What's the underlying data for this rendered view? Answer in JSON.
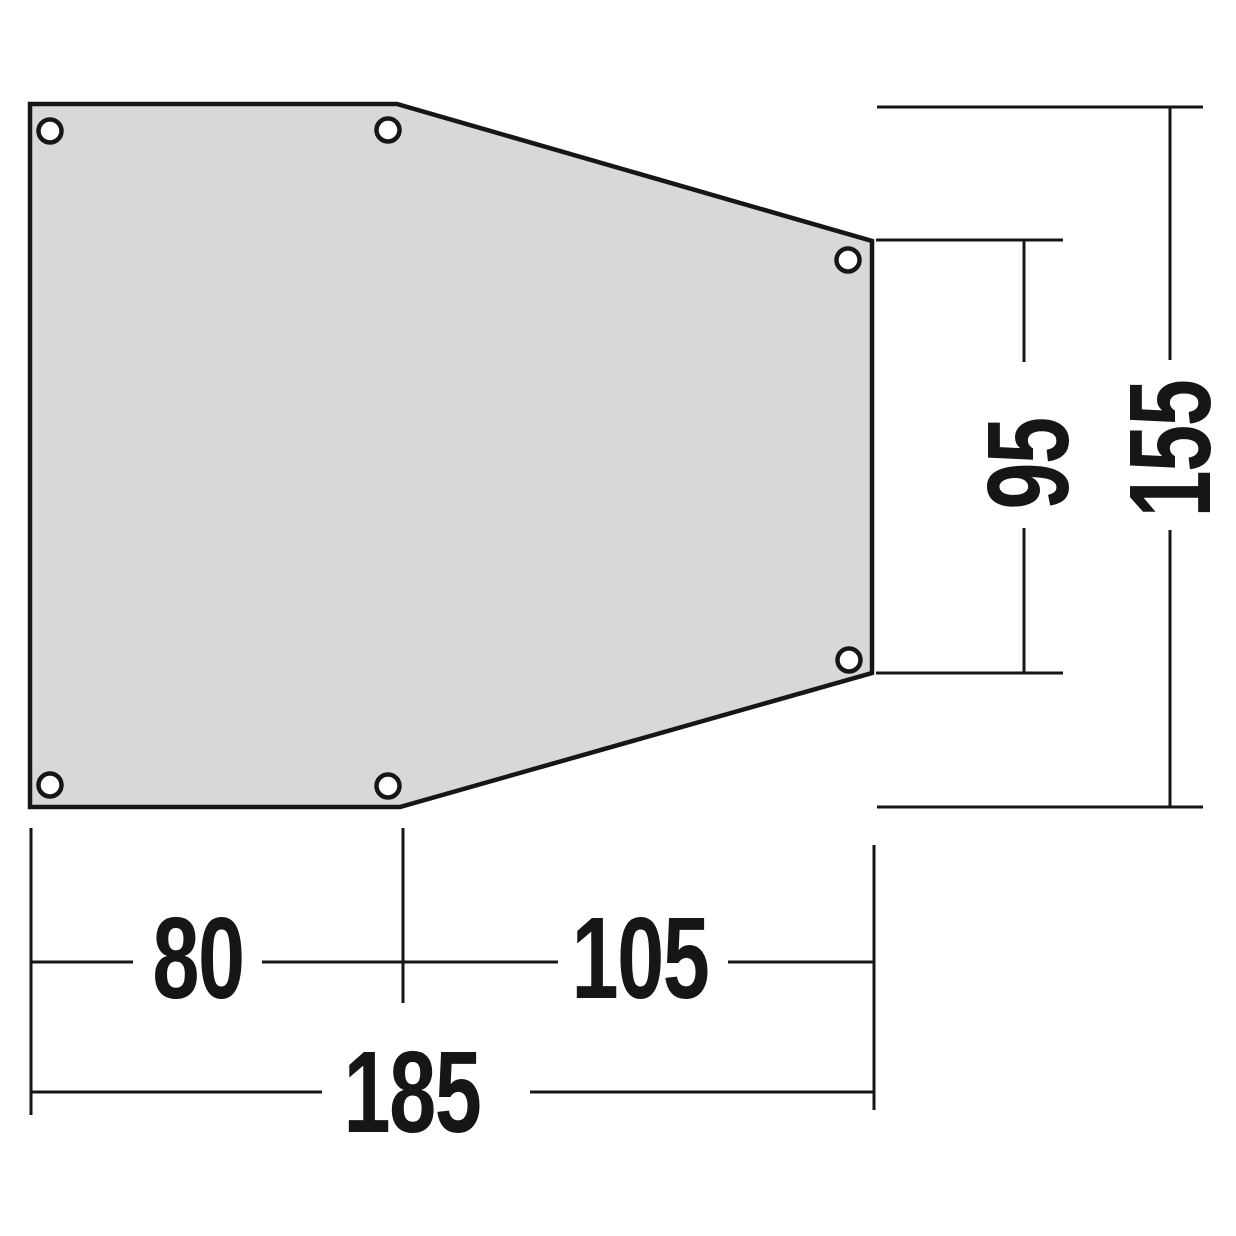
{
  "diagram": {
    "type": "technical-dimension-drawing",
    "subject": "tent-footprint-groundsheet-top-view",
    "grommet_count": 6,
    "dimensions": {
      "bottom_left_width": "80",
      "bottom_right_width": "105",
      "bottom_total_width": "185",
      "right_inner_height": "95",
      "right_total_height": "155"
    },
    "colors": {
      "shape_fill": "#d8d8d8",
      "line_color": "#161616",
      "background": "#ffffff"
    }
  }
}
